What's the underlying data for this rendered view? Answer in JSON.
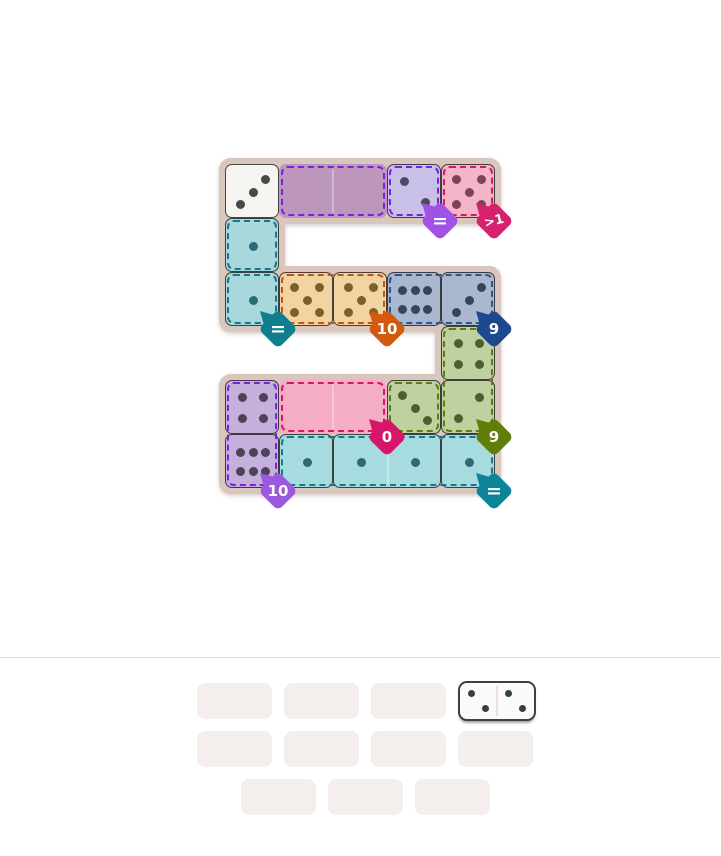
{
  "page": {
    "background": "#ffffff",
    "divider_y": 657,
    "divider_color": "#e3e1df"
  },
  "board": {
    "cell_size": 54,
    "frame_color": "#d9c6bc",
    "cell_border_color": "rgba(38,38,38,0.85)",
    "frame_rects": [
      {
        "x": 219,
        "y": 158,
        "w": 282,
        "h": 66
      },
      {
        "x": 219,
        "y": 158,
        "w": 66,
        "h": 174
      },
      {
        "x": 219,
        "y": 266,
        "w": 282,
        "h": 66
      },
      {
        "x": 435,
        "y": 266,
        "w": 66,
        "h": 174
      },
      {
        "x": 219,
        "y": 374,
        "w": 282,
        "h": 120
      }
    ],
    "cells": [
      {
        "id": "r1c1",
        "x": 225,
        "y": 164,
        "w": 54,
        "h": 54,
        "fill": "#f6f4f1",
        "pip_color": "#484848",
        "layout": "3b",
        "value": "3",
        "bordered": true,
        "state": "placed"
      },
      {
        "id": "r1c2-c3",
        "x": 279,
        "y": 164,
        "w": 108,
        "h": 54,
        "fill": "#bd96bd",
        "pip_color": "",
        "layout": "empty",
        "value": "",
        "bordered": false,
        "seam": true,
        "state": "empty-slot"
      },
      {
        "id": "r1c4",
        "x": 387,
        "y": 164,
        "w": 54,
        "h": 54,
        "fill": "#c9c0e8",
        "pip_color": "#4e4860",
        "layout": "2a",
        "value": "2",
        "bordered": true,
        "state": "placed"
      },
      {
        "id": "r1c5",
        "x": 441,
        "y": 164,
        "w": 54,
        "h": 54,
        "fill": "#f4b5c9",
        "pip_color": "#7c4457",
        "layout": "5",
        "value": "5",
        "bordered": true,
        "state": "placed"
      },
      {
        "id": "r2c1",
        "x": 225,
        "y": 218,
        "w": 54,
        "h": 54,
        "fill": "#a8d8dc",
        "pip_color": "#2c6a75",
        "layout": "1",
        "value": "1",
        "bordered": true,
        "state": "placed"
      },
      {
        "id": "r3c1",
        "x": 225,
        "y": 272,
        "w": 54,
        "h": 54,
        "fill": "#a8d8dc",
        "pip_color": "#2c6a75",
        "layout": "1",
        "value": "1",
        "bordered": true,
        "state": "placed"
      },
      {
        "id": "r3c2",
        "x": 279,
        "y": 272,
        "w": 54,
        "h": 54,
        "fill": "#f2d4a2",
        "pip_color": "#7a6227",
        "layout": "5",
        "value": "5",
        "bordered": true,
        "state": "placed"
      },
      {
        "id": "r3c3",
        "x": 333,
        "y": 272,
        "w": 54,
        "h": 54,
        "fill": "#f2d4a2",
        "pip_color": "#7a6227",
        "layout": "5",
        "value": "5",
        "bordered": true,
        "state": "placed"
      },
      {
        "id": "r3c4",
        "x": 387,
        "y": 272,
        "w": 54,
        "h": 54,
        "fill": "#a9b7cf",
        "pip_color": "#37445d",
        "layout": "6",
        "value": "6",
        "bordered": true,
        "state": "placed"
      },
      {
        "id": "r3c5",
        "x": 441,
        "y": 272,
        "w": 54,
        "h": 54,
        "fill": "#a9b7cf",
        "pip_color": "#37445d",
        "layout": "3b",
        "value": "3",
        "bordered": true,
        "state": "placed"
      },
      {
        "id": "r4c5",
        "x": 441,
        "y": 326,
        "w": 54,
        "h": 54,
        "fill": "#bfd0a1",
        "pip_color": "#4d5f2e",
        "layout": "4",
        "value": "4",
        "bordered": true,
        "state": "placed"
      },
      {
        "id": "r5c1",
        "x": 225,
        "y": 380,
        "w": 54,
        "h": 54,
        "fill": "#c5b0dc",
        "pip_color": "#4a4359",
        "layout": "4",
        "value": "4",
        "bordered": true,
        "state": "placed"
      },
      {
        "id": "r5c2-c3",
        "x": 279,
        "y": 380,
        "w": 108,
        "h": 54,
        "fill": "#f5adc5",
        "pip_color": "",
        "layout": "empty",
        "value": "",
        "bordered": false,
        "seam": true,
        "state": "empty-slot"
      },
      {
        "id": "r5c4",
        "x": 387,
        "y": 380,
        "w": 54,
        "h": 54,
        "fill": "#bfd0a1",
        "pip_color": "#4d5f2e",
        "layout": "3a",
        "value": "3",
        "bordered": true,
        "state": "placed"
      },
      {
        "id": "r5c5",
        "x": 441,
        "y": 380,
        "w": 54,
        "h": 54,
        "fill": "#bfd0a1",
        "pip_color": "#4d5f2e",
        "layout": "2b",
        "value": "2",
        "bordered": true,
        "state": "placed"
      },
      {
        "id": "r6c1",
        "x": 225,
        "y": 434,
        "w": 54,
        "h": 54,
        "fill": "#c5b0dc",
        "pip_color": "#4a4359",
        "layout": "6",
        "value": "6",
        "bordered": true,
        "state": "placed"
      },
      {
        "id": "r6c2",
        "x": 279,
        "y": 434,
        "w": 54,
        "h": 54,
        "fill": "#a6dbe0",
        "pip_color": "#2c6a75",
        "layout": "1",
        "value": "1",
        "bordered": true,
        "state": "placed"
      },
      {
        "id": "r6c3-c4",
        "x": 333,
        "y": 434,
        "w": 108,
        "h": 54,
        "fill": "#a6dbe0",
        "pip_color": "#2c6a75",
        "layout": "1x2",
        "value": "1|1",
        "bordered": true,
        "seam": true,
        "state": "placed"
      },
      {
        "id": "r6c5",
        "x": 441,
        "y": 434,
        "w": 54,
        "h": 54,
        "fill": "#a6dbe0",
        "pip_color": "#2c6a75",
        "layout": "1",
        "value": "1",
        "bordered": true,
        "state": "placed"
      }
    ],
    "regions": [
      {
        "name": "purple-equal-empty",
        "x": 279,
        "y": 164,
        "w": 108,
        "h": 54,
        "color": "#7a22df"
      },
      {
        "name": "purple-equal-filled",
        "x": 387,
        "y": 164,
        "w": 54,
        "h": 54,
        "color": "#7a22df"
      },
      {
        "name": "pink-gt1",
        "x": 441,
        "y": 164,
        "w": 54,
        "h": 54,
        "color": "#d21b5c"
      },
      {
        "name": "teal-equal-a",
        "x": 225,
        "y": 218,
        "w": 54,
        "h": 54,
        "color": "#16798a"
      },
      {
        "name": "teal-equal-b",
        "x": 225,
        "y": 272,
        "w": 54,
        "h": 54,
        "color": "#16798a"
      },
      {
        "name": "orange-sum10",
        "x": 279,
        "y": 272,
        "w": 108,
        "h": 54,
        "color": "#bc561e"
      },
      {
        "name": "navy-sum9",
        "x": 387,
        "y": 272,
        "w": 108,
        "h": 54,
        "color": "#2d5590"
      },
      {
        "name": "green-sum9-vertical",
        "x": 441,
        "y": 326,
        "w": 54,
        "h": 108,
        "color": "#5d7d14"
      },
      {
        "name": "green-sum9-single",
        "x": 387,
        "y": 380,
        "w": 54,
        "h": 54,
        "color": "#5d7d14"
      },
      {
        "name": "pink-sum0-empty",
        "x": 279,
        "y": 380,
        "w": 108,
        "h": 54,
        "color": "#d21b5c"
      },
      {
        "name": "purple-sum10-vertical",
        "x": 225,
        "y": 380,
        "w": 54,
        "h": 108,
        "color": "#7a22df"
      },
      {
        "name": "teal-equal-strip",
        "x": 279,
        "y": 434,
        "w": 216,
        "h": 54,
        "color": "#16798a"
      }
    ],
    "badges": [
      {
        "name": "constraint-equal-purple",
        "label": "=",
        "color": "#a152e6",
        "x": 440,
        "y": 221,
        "font": 19,
        "tilt": 0
      },
      {
        "name": "constraint-greater-than-1",
        "label": ">1",
        "color": "#d6216f",
        "x": 494,
        "y": 221,
        "font": 13,
        "tilt": -14
      },
      {
        "name": "constraint-equal-teal",
        "label": "=",
        "color": "#117e8e",
        "x": 278,
        "y": 329,
        "font": 19,
        "tilt": 0
      },
      {
        "name": "constraint-sum-10-orange",
        "label": "10",
        "color": "#d2590e",
        "x": 387,
        "y": 329,
        "font": 15,
        "tilt": 0
      },
      {
        "name": "constraint-sum-9-navy",
        "label": "9",
        "color": "#1d4a8c",
        "x": 494,
        "y": 329,
        "font": 15,
        "tilt": 0
      },
      {
        "name": "constraint-sum-0-pink",
        "label": "0",
        "color": "#d6156b",
        "x": 387,
        "y": 437,
        "font": 15,
        "tilt": 0
      },
      {
        "name": "constraint-sum-9-olive",
        "label": "9",
        "color": "#617f08",
        "x": 494,
        "y": 437,
        "font": 15,
        "tilt": 0
      },
      {
        "name": "constraint-sum-10-purple",
        "label": "10",
        "color": "#9b59dd",
        "x": 278,
        "y": 491,
        "font": 15,
        "tilt": 0
      },
      {
        "name": "constraint-equal-teal-bottom",
        "label": "=",
        "color": "#0d8598",
        "x": 494,
        "y": 491,
        "font": 19,
        "tilt": 0
      }
    ]
  },
  "tray": {
    "slot_color": "#f4eeec",
    "slot_w": 75,
    "slot_h": 36,
    "slot_radius": 8,
    "rows": [
      {
        "y": 683,
        "xs": [
          197,
          284,
          371,
          458
        ]
      },
      {
        "y": 731,
        "xs": [
          197,
          284,
          371,
          458
        ]
      },
      {
        "y": 779,
        "xs": [
          241,
          328,
          415
        ]
      }
    ],
    "domino": {
      "x": 458,
      "y": 681,
      "w": 78,
      "h": 40,
      "fill": "#fbfafa",
      "border": "#3f3f3f",
      "pip_color": "#3c3c3c",
      "left_pips": 2,
      "right_pips": 2,
      "left_layout": "2a",
      "right_layout": "2a",
      "value": "2|2"
    }
  }
}
